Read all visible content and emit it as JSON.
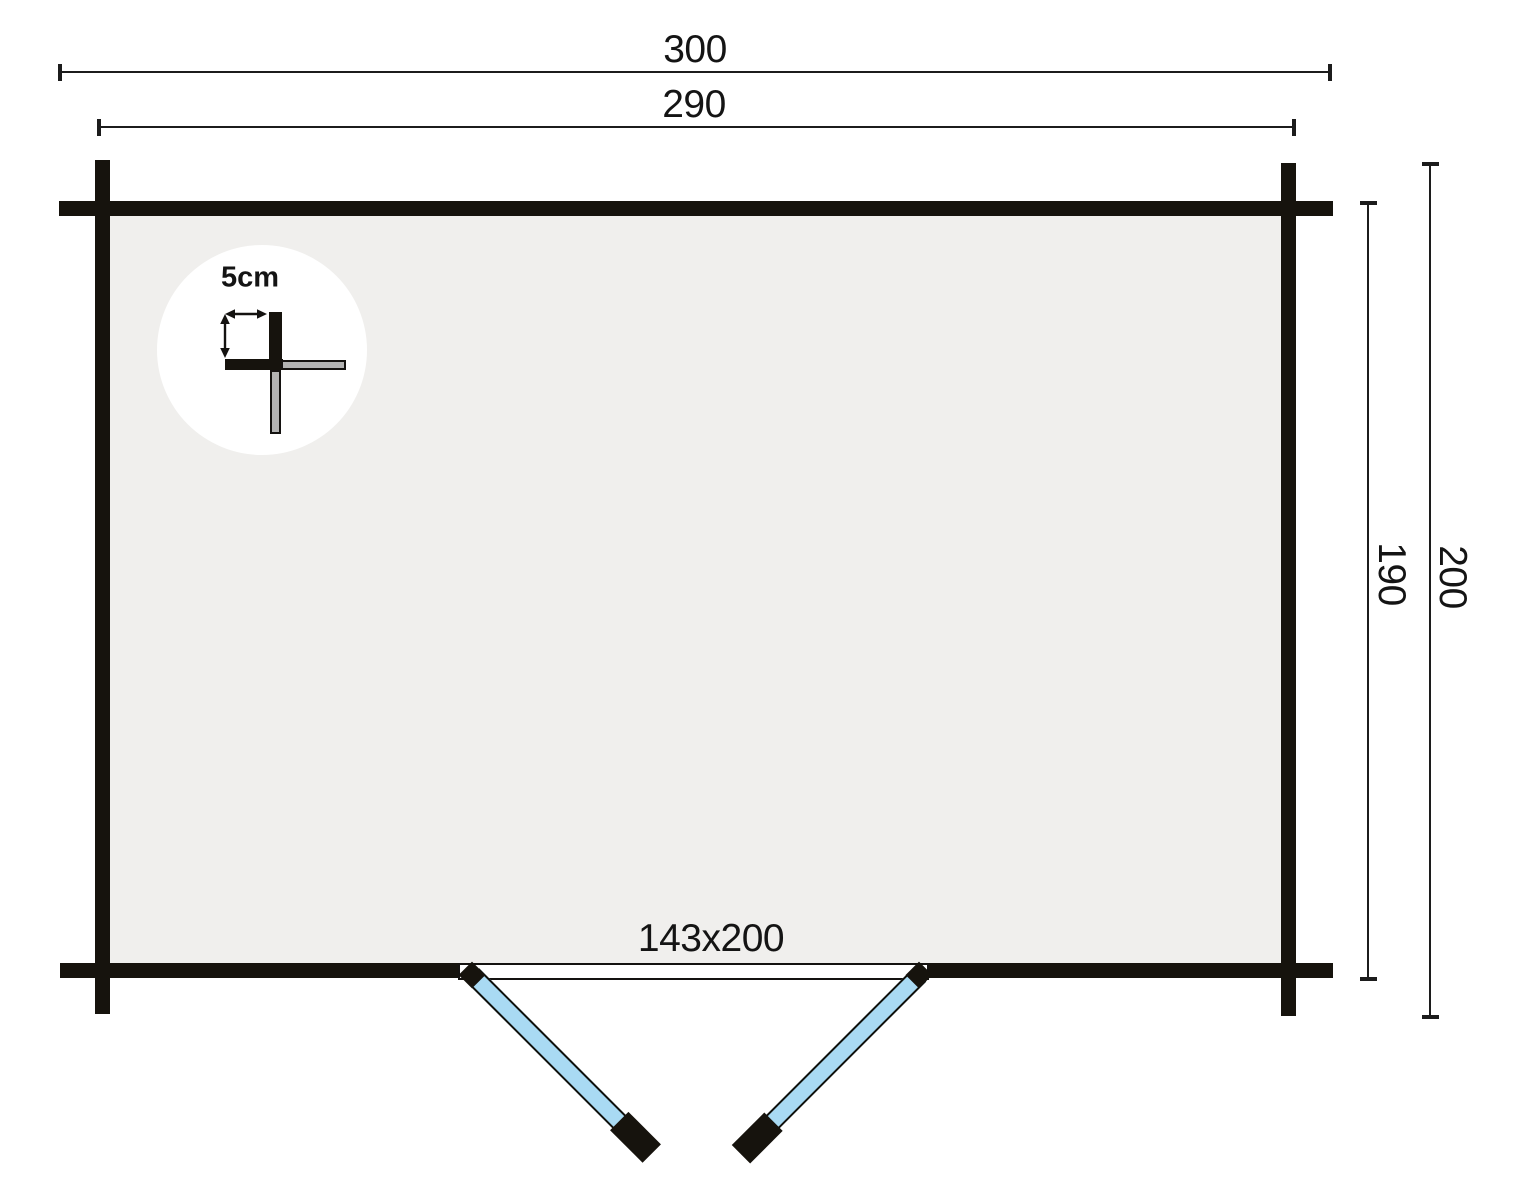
{
  "plan": {
    "dimension_labels": {
      "overall_width": "300",
      "shell_width": "290",
      "shell_depth": "190",
      "overall_depth": "200"
    },
    "door_label": "143x200",
    "wall_detail_label": "5cm",
    "colors": {
      "wall": "#16130d",
      "floor": "#f0efed",
      "door_panel": "#a9daf3",
      "detail_log": "#b3b3b3",
      "dimension_line": "#1c1c1c",
      "background": "#ffffff"
    }
  }
}
